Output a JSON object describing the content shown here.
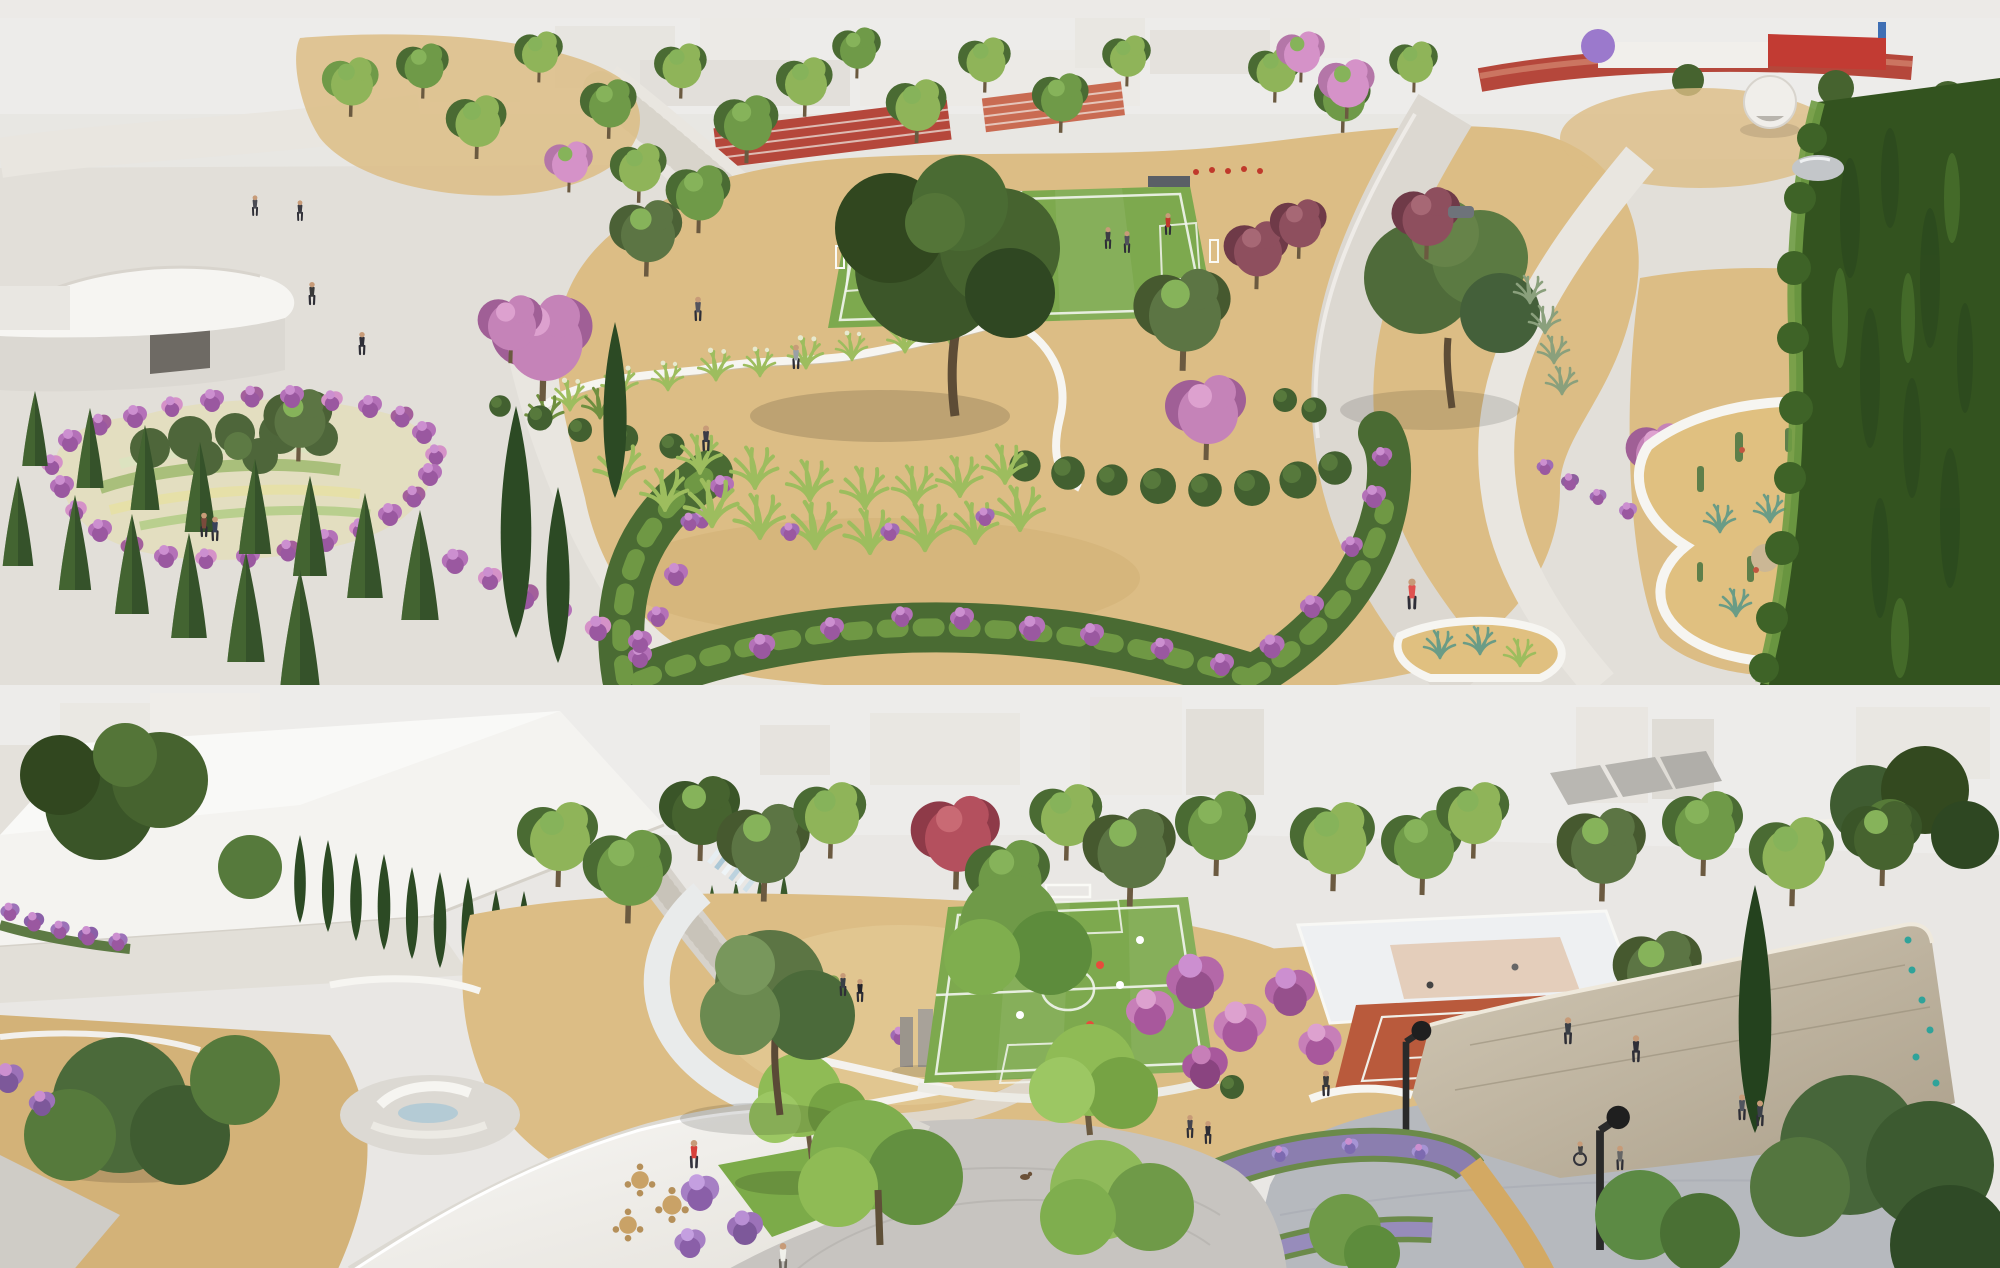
{
  "scene": {
    "description": "Two stacked aerial architectural renderings of a landscaped public park at golden hour",
    "panels": [
      {
        "name": "top-rendering",
        "aria_label": "Aerial rendering of a park: athletics track with red grandstand, sprint lanes, five-a-side soccer pitch, white skyline buildings, curved-roof pavilion, flower parterre with pink border, rows of conical conifers, serpentine white garden walls, clipped ball shrubs, ornamental grasses, cactus garden inside white planter walls, tall clipped hedge, curving footpaths and a jogger in a red top",
        "features": [
          "athletics track",
          "red grandstand",
          "sprint lanes",
          "five-a-side soccer pitch",
          "white skyline buildings",
          "curved-roof pavilion",
          "flower parterre with pink border",
          "rows of conical conifers",
          "tall cypresses",
          "serpentine white garden walls",
          "clipped ball shrubs",
          "ornamental grass beds",
          "shrub border with purple flowers",
          "large shade tree",
          "pink and plum flowering trees",
          "round white kiosk",
          "mirror sculpture",
          "cactus and succulent garden",
          "tall clipped hedge",
          "curving footpaths",
          "jogger in red top",
          "visitors on plaza"
        ]
      },
      {
        "name": "bottom-rendering",
        "aria_label": "Aerial rendering of a park plaza: white museum-like building with cypress hedgerows, stepped water cascade with circular walkway, stone monoliths, five-a-side soccer pitch with players, multi-use court, clay tennis court, magenta flowering trees, stone climbing wall with holds, granite plaza with street lamps, lavender borders, cobblestone plaza with curved steps, white cafe canopy with round tables, small lawn, and a person in a red jacket",
        "features": [
          "white museum building",
          "cypress hedgerows",
          "skyline buildings",
          "stepped water cascade",
          "circular walkway",
          "stone monoliths",
          "five-a-side soccer pitch with players",
          "multi-use court",
          "clay tennis court",
          "magenta flowering trees",
          "stone climbing wall with climbing holds",
          "granite event plaza",
          "street lamps",
          "tall cypress",
          "lavender borders",
          "cobblestone plaza with curved steps",
          "white cafe canopy",
          "round wooden tables with chairs",
          "small lawn with tree",
          "person in red jacket",
          "visitors walking",
          "dog on plaza"
        ]
      }
    ]
  },
  "palette": {
    "sky": "#edecea",
    "plaza": "#e2dfd9",
    "plaza-deep": "#d7d3cc",
    "path": "#e9e6e0",
    "path-deep": "#dcd8d1",
    "white": "#f6f5f1",
    "wall-shade": "#c8c2b6",
    "sand": "#dcbd85",
    "sand-deep": "#cfae72",
    "sand-soft": "#e4cb97",
    "grass-field": "#7da94e",
    "grass-stripe": "#8ab257",
    "lawn": "#7cab49",
    "tree-light": "#8fb459",
    "tree-mid": "#6f9a48",
    "tree-dark": "#46632f",
    "tree-deep": "#3a5528",
    "olive": "#5c7544",
    "cypress": "#2c4a24",
    "conifer": "#35522a",
    "conifer-light": "#4e7236",
    "flower-pink": "#d592c8",
    "flower-magenta": "#b468a8",
    "flower-purple": "#a06bb5",
    "lavender": "#9c8cc8",
    "plum": "#8e4f5e",
    "red-leaf": "#b4505e",
    "grass-blade": "#9dbd5e",
    "grass-plume": "#e7e9cf",
    "track-red": "#b5473b",
    "track-red-2": "#c96b52",
    "clay": "#b95a3c",
    "stone-light": "#d2c9b6",
    "stone-dark": "#ab9f8a",
    "granite": "#b6b9be",
    "cobble": "#c7c4c0",
    "cobble-line": "#b7b4af",
    "water": "#aac7d6",
    "wood": "#c9a267",
    "accent-red": "#d7403a",
    "teal": "#2fa39a",
    "figure": "#3a3a3a"
  }
}
